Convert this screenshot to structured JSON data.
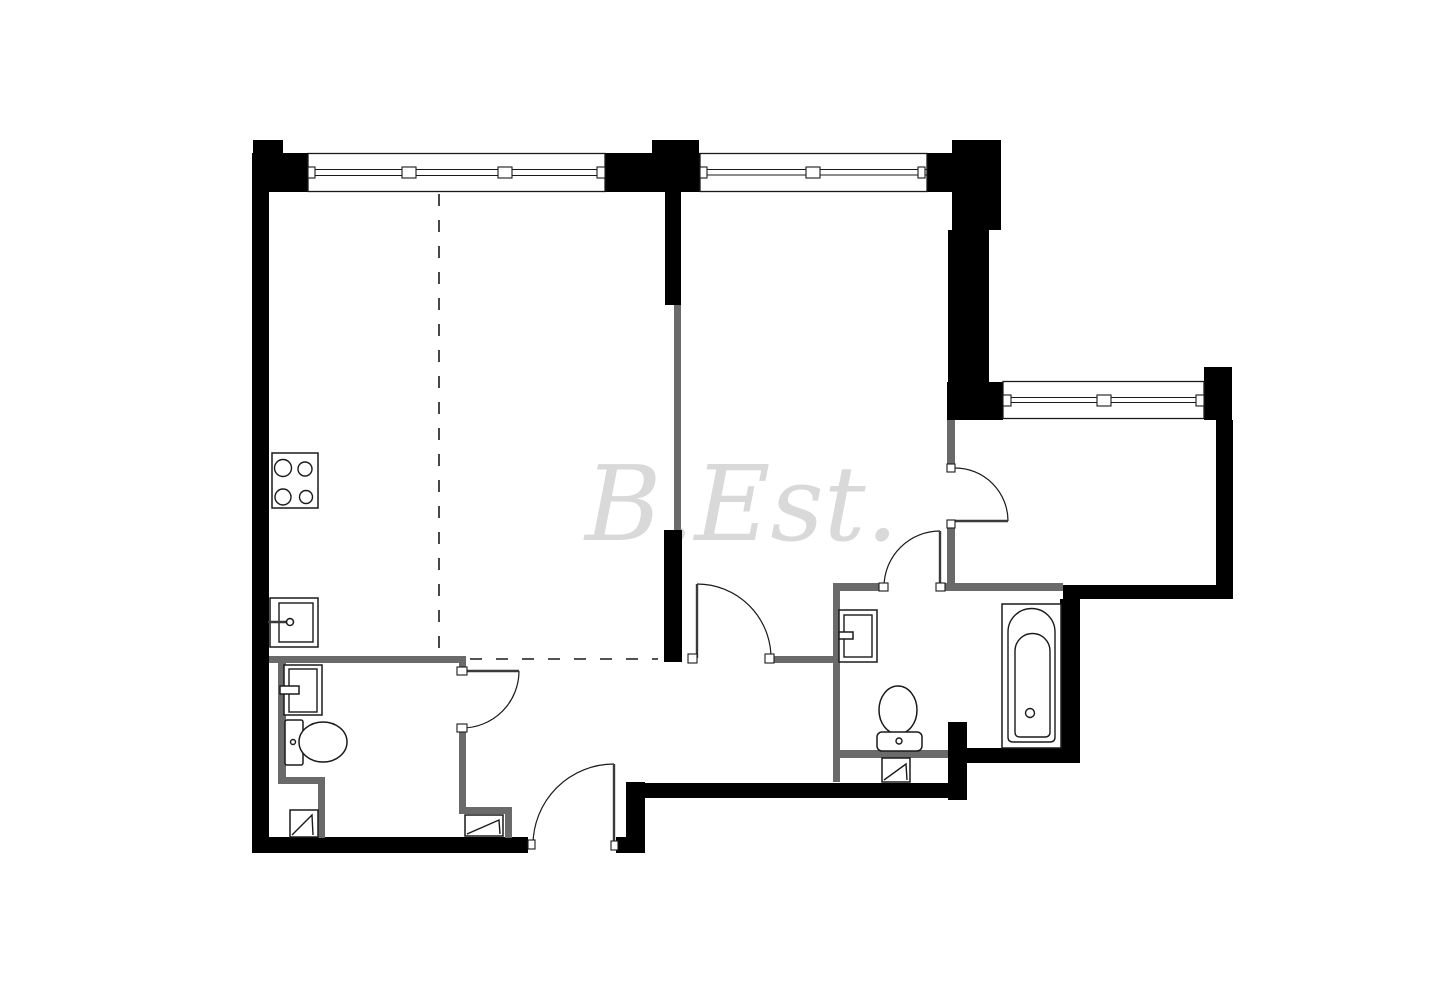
{
  "watermark": {
    "text": "B.Est."
  },
  "colors": {
    "background": "#ffffff",
    "outer_wall": "#000000",
    "partition_wall": "#6a6a6a",
    "line": "#1a1a1a",
    "watermark": "#d9d9d9"
  },
  "plan": {
    "type": "apartment-floor-plan",
    "window_count": 3,
    "door_count": 5,
    "fixture_icons": [
      "stove-icon",
      "kitchen-sink-icon",
      "bathroom-sink-icon",
      "toilet-icon",
      "bathtub-icon",
      "ventilation-shaft-icon"
    ]
  }
}
